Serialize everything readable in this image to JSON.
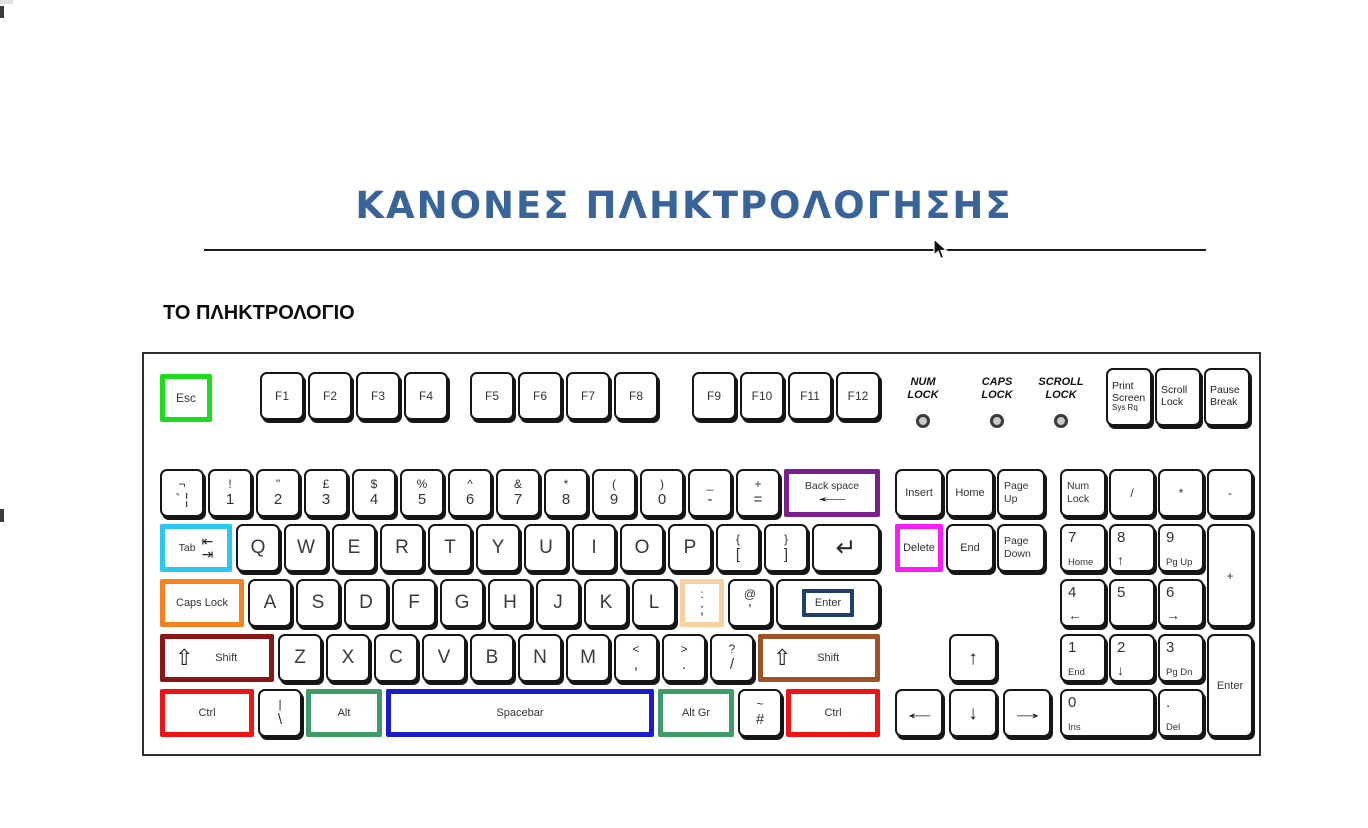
{
  "page": {
    "title": "ΚΑΝΟΝΕΣ ΠΛΗΚΤΡΟΛΟΓΗΣΗΣ",
    "title_color": "#38649a",
    "section_heading": "ΤΟ ΠΛΗΚΤΡΟΛΟΓΙΟ"
  },
  "colors": {
    "green": "#1ddb1d",
    "purple": "#7b1f8a",
    "cyan": "#29c8f2",
    "orange": "#f5821f",
    "darkred": "#8c1515",
    "brown": "#a05227",
    "red": "#ee1414",
    "altgreen": "#3f9b68",
    "blue": "#1c1ccd",
    "navy": "#1e3f6e",
    "magenta": "#fb1cfb",
    "peach": "#f6cfa2"
  },
  "glyphs": {
    "shift": "⇧",
    "ret": "↵",
    "tab_in": "⇤",
    "tab_out": "⇥",
    "left": "←",
    "up": "↑",
    "down": "↓",
    "right": "→"
  },
  "keyboard": {
    "esc": {
      "t": "s",
      "label": "Esc",
      "hl": "green",
      "fs": "sm",
      "w": 52,
      "name": "key-esc"
    },
    "function_groups": [
      [
        "F1",
        "F2",
        "F3",
        "F4"
      ],
      [
        "F5",
        "F6",
        "F7",
        "F8"
      ],
      [
        "F9",
        "F10",
        "F11",
        "F12"
      ]
    ],
    "indicators": [
      {
        "lines": [
          "NUM",
          "LOCK"
        ],
        "name": "num-lock"
      },
      {
        "lines": [
          "CAPS",
          "LOCK"
        ],
        "name": "caps-lock"
      },
      {
        "lines": [
          "SCROLL",
          "LOCK"
        ],
        "name": "scroll-lock"
      }
    ],
    "system_keys": [
      {
        "lines": [
          "Print",
          "Screen",
          "Sys Rq"
        ],
        "name": "key-print-screen"
      },
      {
        "lines": [
          "Scroll",
          "Lock"
        ],
        "name": "key-scroll-lock"
      },
      {
        "lines": [
          "Pause",
          "Break"
        ],
        "name": "key-pause-break"
      }
    ],
    "rows": [
      [
        {
          "t": "d",
          "top": "¬",
          "bottom": "` ¦",
          "name": "key-grave"
        },
        {
          "t": "d",
          "top": "!",
          "bottom": "1",
          "name": "key-1"
        },
        {
          "t": "d",
          "top": "\"",
          "bottom": "2",
          "name": "key-2"
        },
        {
          "t": "d",
          "top": "£",
          "bottom": "3",
          "name": "key-3"
        },
        {
          "t": "d",
          "top": "$",
          "bottom": "4",
          "name": "key-4"
        },
        {
          "t": "d",
          "top": "%",
          "bottom": "5",
          "name": "key-5"
        },
        {
          "t": "d",
          "top": "^",
          "bottom": "6",
          "name": "key-6"
        },
        {
          "t": "d",
          "top": "&",
          "bottom": "7",
          "name": "key-7"
        },
        {
          "t": "d",
          "top": "*",
          "bottom": "8",
          "name": "key-8"
        },
        {
          "t": "d",
          "top": "(",
          "bottom": "9",
          "name": "key-9"
        },
        {
          "t": "d",
          "top": ")",
          "bottom": "0",
          "name": "key-0"
        },
        {
          "t": "d",
          "top": "_",
          "bottom": "-",
          "name": "key-minus"
        },
        {
          "t": "d",
          "top": "+",
          "bottom": "=",
          "name": "key-equals"
        },
        {
          "t": "bksp",
          "label": "Back space",
          "hl": "purple",
          "flex": 1,
          "name": "key-backspace"
        }
      ],
      [
        {
          "t": "tab",
          "label": "Tab",
          "hl": "cyan",
          "w": 72,
          "name": "key-tab"
        },
        {
          "t": "s",
          "label": "Q",
          "fs": "lg",
          "name": "key-q"
        },
        {
          "t": "s",
          "label": "W",
          "fs": "lg",
          "name": "key-w"
        },
        {
          "t": "s",
          "label": "E",
          "fs": "lg",
          "name": "key-e"
        },
        {
          "t": "s",
          "label": "R",
          "fs": "lg",
          "name": "key-r"
        },
        {
          "t": "s",
          "label": "T",
          "fs": "lg",
          "name": "key-t"
        },
        {
          "t": "s",
          "label": "Y",
          "fs": "lg",
          "name": "key-y"
        },
        {
          "t": "s",
          "label": "U",
          "fs": "lg",
          "name": "key-u"
        },
        {
          "t": "s",
          "label": "I",
          "fs": "lg",
          "name": "key-i"
        },
        {
          "t": "s",
          "label": "O",
          "fs": "lg",
          "name": "key-o"
        },
        {
          "t": "s",
          "label": "P",
          "fs": "lg",
          "name": "key-p"
        },
        {
          "t": "d",
          "top": "{",
          "bottom": "[",
          "name": "key-left-bracket"
        },
        {
          "t": "d",
          "top": "}",
          "bottom": "]",
          "name": "key-right-bracket"
        },
        {
          "t": "ret",
          "flex": 1,
          "name": "key-return"
        }
      ],
      [
        {
          "t": "s",
          "label": "Caps Lock",
          "hl": "orange",
          "w": 84,
          "fs": "xs",
          "name": "key-caps-lock"
        },
        {
          "t": "s",
          "label": "A",
          "fs": "lg",
          "name": "key-a"
        },
        {
          "t": "s",
          "label": "S",
          "fs": "lg",
          "name": "key-s"
        },
        {
          "t": "s",
          "label": "D",
          "fs": "lg",
          "name": "key-d"
        },
        {
          "t": "s",
          "label": "F",
          "fs": "lg",
          "name": "key-f"
        },
        {
          "t": "s",
          "label": "G",
          "fs": "lg",
          "name": "key-g"
        },
        {
          "t": "s",
          "label": "H",
          "fs": "lg",
          "name": "key-h"
        },
        {
          "t": "s",
          "label": "J",
          "fs": "lg",
          "name": "key-j"
        },
        {
          "t": "s",
          "label": "K",
          "fs": "lg",
          "name": "key-k"
        },
        {
          "t": "s",
          "label": "L",
          "fs": "lg",
          "name": "key-l"
        },
        {
          "t": "d",
          "top": ":",
          "bottom": ";",
          "hl": "peach",
          "name": "key-semicolon"
        },
        {
          "t": "d",
          "top": "@",
          "bottom": "'",
          "name": "key-apostrophe"
        },
        {
          "t": "enter3",
          "label": "Enter",
          "flex": 1,
          "name": "key-enter"
        }
      ],
      [
        {
          "t": "shift",
          "label": "Shift",
          "hl": "darkred",
          "w": 114,
          "name": "key-left-shift"
        },
        {
          "t": "s",
          "label": "Z",
          "fs": "lg",
          "name": "key-z"
        },
        {
          "t": "s",
          "label": "X",
          "fs": "lg",
          "name": "key-x"
        },
        {
          "t": "s",
          "label": "C",
          "fs": "lg",
          "name": "key-c"
        },
        {
          "t": "s",
          "label": "V",
          "fs": "lg",
          "name": "key-v"
        },
        {
          "t": "s",
          "label": "B",
          "fs": "lg",
          "name": "key-b"
        },
        {
          "t": "s",
          "label": "N",
          "fs": "lg",
          "name": "key-n"
        },
        {
          "t": "s",
          "label": "M",
          "fs": "lg",
          "name": "key-m"
        },
        {
          "t": "d",
          "top": "<",
          "bottom": ",",
          "name": "key-comma"
        },
        {
          "t": "d",
          "top": ">",
          "bottom": ".",
          "name": "key-period"
        },
        {
          "t": "d",
          "top": "?",
          "bottom": "/",
          "name": "key-slash"
        },
        {
          "t": "shift",
          "label": "Shift",
          "hl": "brown",
          "flex": 1,
          "name": "key-right-shift"
        }
      ],
      [
        {
          "t": "s",
          "label": "Ctrl",
          "hl": "red",
          "w": 94,
          "fs": "xs",
          "name": "key-left-ctrl"
        },
        {
          "t": "d",
          "top": "|",
          "bottom": "\\",
          "name": "key-backslash"
        },
        {
          "t": "s",
          "label": "Alt",
          "hl": "altgreen",
          "w": 76,
          "fs": "xs",
          "name": "key-alt"
        },
        {
          "t": "s",
          "label": "Spacebar",
          "hl": "blue",
          "flex": 1,
          "fs": "xs",
          "name": "key-spacebar"
        },
        {
          "t": "s",
          "label": "Alt Gr",
          "hl": "altgreen",
          "w": 76,
          "fs": "xs",
          "name": "key-alt-gr"
        },
        {
          "t": "d",
          "top": "~",
          "bottom": "#",
          "name": "key-hash"
        },
        {
          "t": "s",
          "label": "Ctrl",
          "hl": "red",
          "w": 94,
          "fs": "xs",
          "name": "key-right-ctrl"
        }
      ]
    ],
    "nav_rows": [
      [
        {
          "t": "s",
          "label": "Insert",
          "fs": "xs",
          "w": 48,
          "name": "key-insert"
        },
        {
          "t": "s",
          "label": "Home",
          "fs": "xs",
          "w": 48,
          "name": "key-home"
        },
        {
          "t": "ml",
          "lines": [
            "Page",
            "Up"
          ],
          "w": 48,
          "name": "key-page-up"
        }
      ],
      [
        {
          "t": "s",
          "label": "Delete",
          "hl": "magenta",
          "fs": "xs",
          "w": 48,
          "name": "key-delete"
        },
        {
          "t": "s",
          "label": "End",
          "fs": "xs",
          "w": 48,
          "name": "key-end"
        },
        {
          "t": "ml",
          "lines": [
            "Page",
            "Down"
          ],
          "w": 48,
          "name": "key-page-down"
        }
      ]
    ],
    "arrow_up": {
      "t": "arr",
      "glyph": "↑",
      "w": 48,
      "name": "key-arrow-up"
    },
    "arrow_row": [
      {
        "t": "arr",
        "glyph": "←",
        "h": true,
        "w": 48,
        "name": "key-arrow-left"
      },
      {
        "t": "arr",
        "glyph": "↓",
        "w": 48,
        "name": "key-arrow-down"
      },
      {
        "t": "arr",
        "glyph": "→",
        "h": true,
        "w": 48,
        "name": "key-arrow-right"
      }
    ],
    "numpad": [
      [
        {
          "t": "ml",
          "lines": [
            "Num",
            "Lock"
          ],
          "col": 0,
          "name": "key-num-lock"
        },
        {
          "t": "s",
          "label": "/",
          "fs": "sm",
          "col": 1,
          "name": "key-numpad-divide"
        },
        {
          "t": "s",
          "label": "*",
          "fs": "sm",
          "col": 2,
          "name": "key-numpad-multiply"
        },
        {
          "t": "s",
          "label": "-",
          "fs": "sm",
          "col": 3,
          "name": "key-numpad-minus"
        }
      ],
      [
        {
          "t": "c",
          "top": "7",
          "bottom": "Home",
          "col": 0,
          "name": "key-numpad-7"
        },
        {
          "t": "c",
          "top": "8",
          "bottom": "↑",
          "col": 1,
          "name": "key-numpad-8"
        },
        {
          "t": "c",
          "top": "9",
          "bottom": "Pg Up",
          "col": 2,
          "name": "key-numpad-9"
        },
        {
          "t": "s",
          "label": "+",
          "fs": "sm",
          "col": 3,
          "tall": true,
          "name": "key-numpad-plus"
        }
      ],
      [
        {
          "t": "c",
          "top": "4",
          "bottom": "←",
          "col": 0,
          "name": "key-numpad-4"
        },
        {
          "t": "c",
          "top": "5",
          "bottom": "",
          "col": 1,
          "name": "key-numpad-5"
        },
        {
          "t": "c",
          "top": "6",
          "bottom": "→",
          "col": 2,
          "name": "key-numpad-6"
        }
      ],
      [
        {
          "t": "c",
          "top": "1",
          "bottom": "End",
          "col": 0,
          "name": "key-numpad-1"
        },
        {
          "t": "c",
          "top": "2",
          "bottom": "↓",
          "col": 1,
          "name": "key-numpad-2"
        },
        {
          "t": "c",
          "top": "3",
          "bottom": "Pg Dn",
          "col": 2,
          "name": "key-numpad-3"
        },
        {
          "t": "s",
          "label": "Enter",
          "fs": "xs",
          "col": 3,
          "tall": true,
          "name": "key-numpad-enter"
        }
      ],
      [
        {
          "t": "c",
          "top": "0",
          "bottom": "Ins",
          "col": 0,
          "wide": true,
          "name": "key-numpad-0"
        },
        {
          "t": "c",
          "top": ".",
          "bottom": "Del",
          "col": 2,
          "name": "key-numpad-decimal"
        }
      ]
    ]
  }
}
